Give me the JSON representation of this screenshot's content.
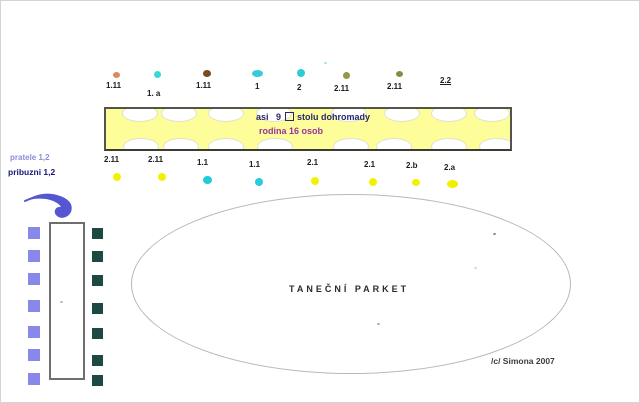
{
  "diagram_title": "wedding seating plan sketch",
  "colors": {
    "table_fill": "#fdfd9a",
    "cyan_dot": "#2accd8",
    "yellow_dot": "#f2f200",
    "salmon_dot": "#dd8a5a",
    "brown_dot": "#7a4a20",
    "olive_dot": "#92924a",
    "friends_text": "#8c8cdc",
    "relatives_text": "#16167a",
    "arrow": "#5656d2",
    "left_squares": "#8888ea",
    "right_squares": "#1c4a42"
  },
  "seats_top": [
    {
      "label": "1.11",
      "label_x": 105,
      "label_y": 80,
      "dot": {
        "x": 112,
        "y": 71,
        "w": 7,
        "h": 6,
        "color": "#dd8a5a"
      }
    },
    {
      "label": "1. a",
      "label_x": 146,
      "label_y": 88,
      "dot": {
        "x": 153,
        "y": 70,
        "w": 7,
        "h": 7,
        "color": "#38d8d8"
      }
    },
    {
      "label": "1.11",
      "label_x": 195,
      "label_y": 80,
      "dot": {
        "x": 202,
        "y": 69,
        "w": 8,
        "h": 7,
        "color": "#7a4a20"
      }
    },
    {
      "label": "1",
      "label_x": 254,
      "label_y": 81,
      "dot": {
        "x": 251,
        "y": 69,
        "w": 11,
        "h": 7,
        "color": "#34ccd8"
      }
    },
    {
      "label": "2",
      "label_x": 296,
      "label_y": 82,
      "dot": {
        "x": 296,
        "y": 68,
        "w": 8,
        "h": 8,
        "color": "#2cccd8"
      }
    },
    {
      "label": "2.11",
      "label_x": 333,
      "label_y": 83,
      "dot": {
        "x": 342,
        "y": 71,
        "w": 7,
        "h": 7,
        "color": "#96964c"
      }
    },
    {
      "label": "2.11",
      "label_x": 386,
      "label_y": 81,
      "dot": {
        "x": 395,
        "y": 70,
        "w": 7,
        "h": 6,
        "color": "#8a8a48"
      }
    },
    {
      "label": "2.2",
      "label_x": 439,
      "label_y": 75,
      "underline": true,
      "dot": null
    }
  ],
  "seats_bottom": [
    {
      "label": "2.11",
      "label_x": 103,
      "label_y": 154,
      "dot": {
        "x": 112,
        "y": 172,
        "w": 8,
        "h": 8,
        "color": "#f2f200"
      }
    },
    {
      "label": "2.11",
      "label_x": 147,
      "label_y": 154,
      "dot": {
        "x": 157,
        "y": 172,
        "w": 8,
        "h": 8,
        "color": "#f2f200"
      }
    },
    {
      "label": "1.1",
      "label_x": 196,
      "label_y": 157,
      "dot": {
        "x": 202,
        "y": 175,
        "w": 9,
        "h": 8,
        "color": "#20ccda"
      }
    },
    {
      "label": "1.1",
      "label_x": 248,
      "label_y": 159,
      "dot": {
        "x": 254,
        "y": 177,
        "w": 8,
        "h": 8,
        "color": "#28ccda"
      }
    },
    {
      "label": "2.1",
      "label_x": 306,
      "label_y": 157,
      "dot": {
        "x": 310,
        "y": 176,
        "w": 8,
        "h": 8,
        "color": "#f2f200"
      }
    },
    {
      "label": "2.1",
      "label_x": 363,
      "label_y": 159,
      "dot": {
        "x": 368,
        "y": 177,
        "w": 8,
        "h": 8,
        "color": "#f2f200"
      }
    },
    {
      "label": "2.b",
      "label_x": 405,
      "label_y": 160,
      "dot": {
        "x": 411,
        "y": 178,
        "w": 8,
        "h": 7,
        "color": "#f2f200"
      }
    },
    {
      "label": "2.a",
      "label_x": 443,
      "label_y": 162,
      "dot": {
        "x": 446,
        "y": 179,
        "w": 11,
        "h": 8,
        "color": "#f0f000"
      }
    }
  ],
  "banquet_table": {
    "line1_a": "asi   9",
    "line1_b": "stolu dohromady",
    "line2": "rodina 16 osob",
    "plates_top_x": [
      16,
      55,
      102,
      150,
      225,
      278,
      325,
      368
    ],
    "plates_bottom_x": [
      17,
      57,
      102,
      151,
      227,
      270,
      325,
      373
    ]
  },
  "guest_groups": {
    "friends": "pratele 1,2",
    "relatives": "pribuzni 1,2"
  },
  "left_table": {
    "left_square_ys": [
      226,
      249,
      272,
      299,
      325,
      348,
      372
    ],
    "right_square_ys": [
      227,
      250,
      274,
      302,
      327,
      354,
      374
    ]
  },
  "dance_floor": {
    "label": "TANEČNÍ PARKET"
  },
  "signature": "/c/ Simona 2007",
  "specks": [
    {
      "x": 323,
      "y": 61,
      "color": "#8ae0e4"
    },
    {
      "x": 492,
      "y": 232,
      "color": "#777777"
    },
    {
      "x": 473,
      "y": 266,
      "color": "#a8e2e2"
    },
    {
      "x": 376,
      "y": 322,
      "color": "#9a9a9a"
    },
    {
      "x": 59,
      "y": 300,
      "color": "#aaaaaa"
    }
  ]
}
